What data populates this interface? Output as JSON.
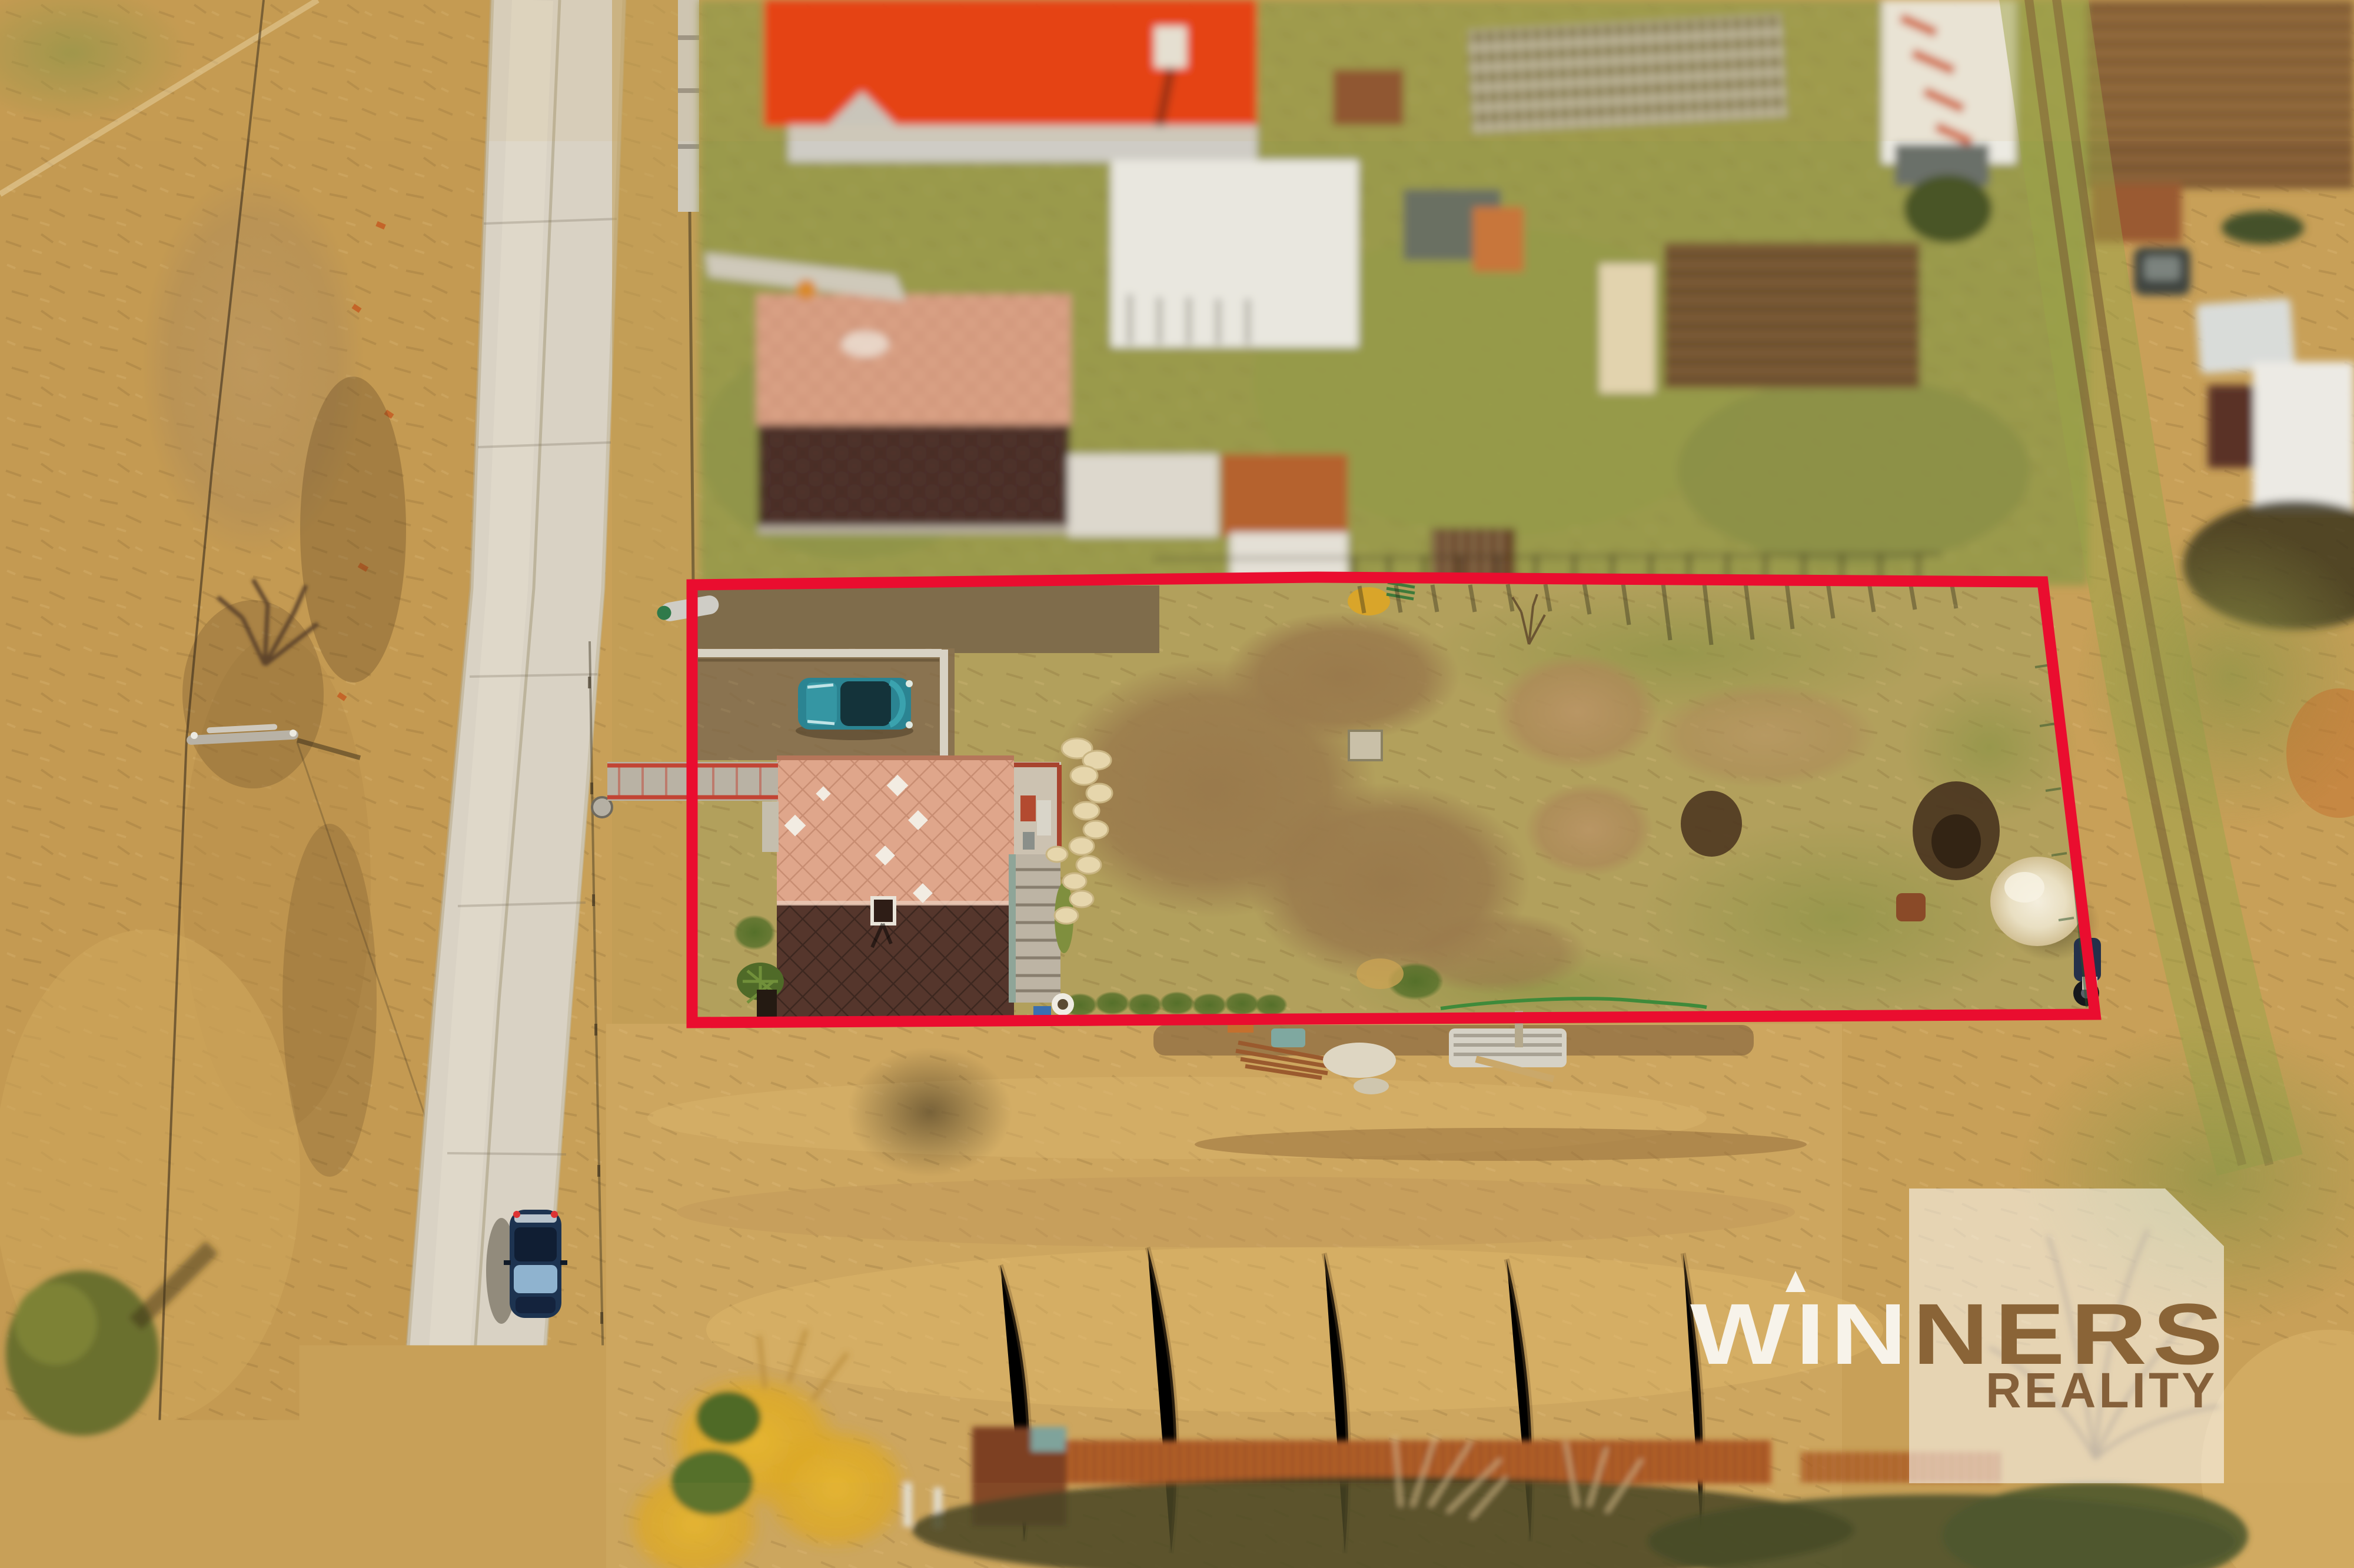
{
  "image": {
    "kind": "aerial drone photograph",
    "subject": "rural building plot with family house outlined in red for a real-estate listing",
    "season": "early spring, dry tan grass"
  },
  "watermark": {
    "brand_part1": "WIN",
    "brand_part2": "NERS",
    "brand_line2": "REALITY",
    "square_color": "#ffffff",
    "square_opacity": "0.55",
    "knockout_color": "#8a6437",
    "light_text_color": "#f7f3ea"
  },
  "boundary": {
    "color": "#EA0D2F",
    "stroke_width": "19"
  },
  "colors": {
    "road": "#d9d2c4",
    "field_tan": "#c8a058",
    "plot_grass": "#b2a05c",
    "dirt": "#9a7a4c",
    "house_roof_upper": "#dfa68b",
    "house_roof_lower": "#55362c",
    "neighbor_roof_upper": "#d9a084",
    "neighbor_roof_lower": "#4f332a",
    "red_roof": "#e8380d",
    "rust_barn": "#b4602a",
    "teal_car": "#2b8492",
    "navy_car": "#1d3350",
    "sand_pile": "#efe7d1",
    "hedge_green": "#5c7a2c",
    "forsythia_gold": "#dca928"
  }
}
